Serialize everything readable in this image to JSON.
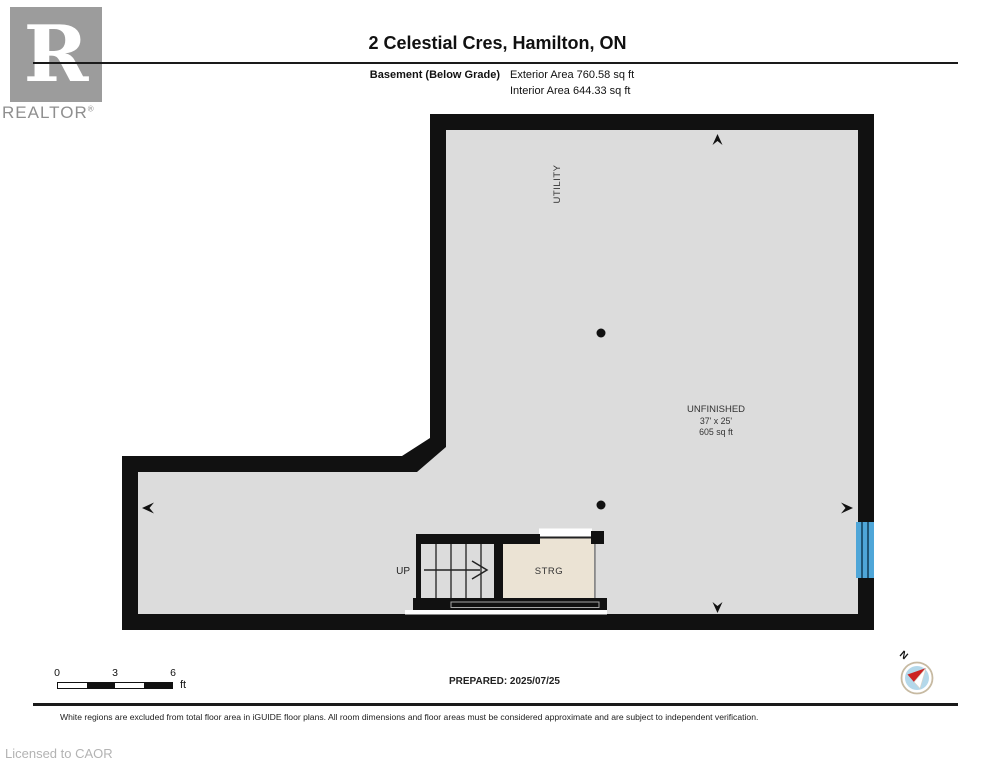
{
  "header": {
    "logo": {
      "letter": "R",
      "brand": "REALTOR",
      "registered": "®"
    },
    "title": "2 Celestial Cres, Hamilton, ON",
    "floor_label": "Basement (Below Grade)",
    "exterior_area": "Exterior Area 760.58 sq ft",
    "interior_area": "Interior Area 644.33 sq ft"
  },
  "plan": {
    "rooms": {
      "utility_label": "UTILITY",
      "unfinished_name": "UNFINISHED",
      "unfinished_dimensions": "37' x 25'",
      "unfinished_area": "605 sq ft",
      "storage_label": "STRG",
      "stairs_label": "UP"
    },
    "colors": {
      "wall": "#111111",
      "interior_fill": "#dcdcdc",
      "storage_fill": "#ebe3d4",
      "window_blue": "#4fa6d8"
    }
  },
  "footer": {
    "scale": {
      "ticks": [
        "0",
        "3",
        "6"
      ],
      "unit": "ft"
    },
    "prepared": "PREPARED: 2025/07/25",
    "compass_label": "N",
    "disclaimer": "White regions are excluded from total floor area in iGUIDE floor plans. All room dimensions and floor areas must be considered approximate and are subject to independent verification.",
    "license": "Licensed to CAOR"
  }
}
